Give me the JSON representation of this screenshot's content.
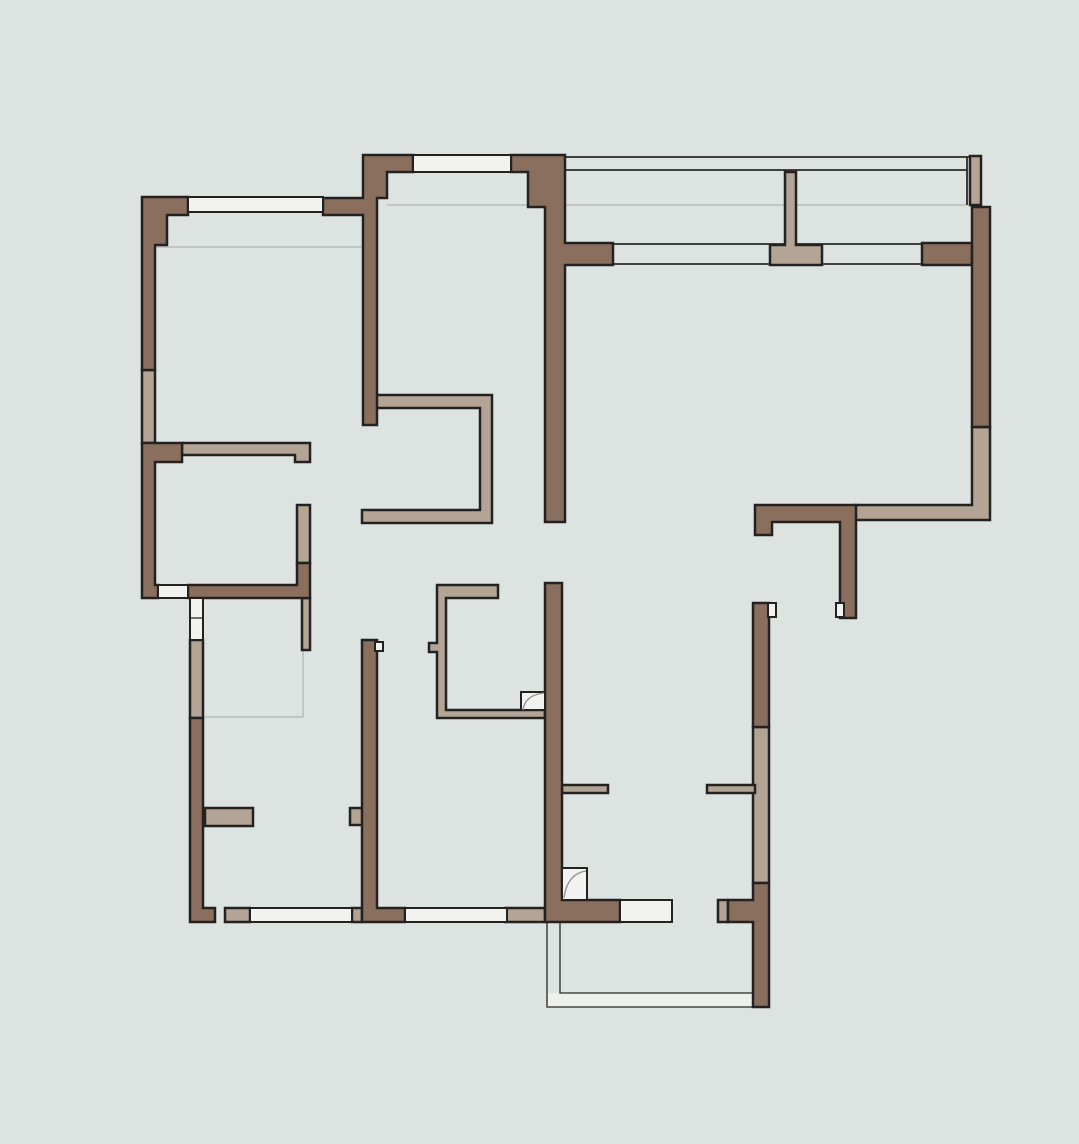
{
  "canvas": {
    "width": 1079,
    "height": 1144,
    "background": "#dde3e1"
  },
  "palette": {
    "background": "#dde3e1",
    "wall_brown": "#8a6e5e",
    "wall_beige": "#b3a496",
    "outline": "#242220",
    "window_white": "#f2f2f0",
    "faint_line": "#b5bcba",
    "swing_line": "#8a8f8d",
    "band_fill": "#eef0ee"
  },
  "layers": {
    "faint": {
      "stroke": "#b5bcba",
      "width": 1.5,
      "fill": "none"
    },
    "band-fill": {
      "stroke": "none",
      "width": 0,
      "fill": "#eef0ee"
    },
    "dark-line": {
      "stroke": "#2a2824",
      "width": 1.8,
      "fill": "none"
    },
    "thin-line": {
      "stroke": "#2a2824",
      "width": 1.3,
      "fill": "none"
    },
    "beige": {
      "stroke": "#242220",
      "width": 2.5,
      "fill": "#b3a496"
    },
    "brown": {
      "stroke": "#242220",
      "width": 2.5,
      "fill": "#8a6e5e"
    },
    "white": {
      "stroke": "#242220",
      "width": 2,
      "fill": "#f2f2f0"
    },
    "swing": {
      "stroke": "#8a8f8d",
      "width": 1.3,
      "fill": "none"
    }
  },
  "floorplan": {
    "elements": [
      {
        "name": "bedroom1-curtain-line",
        "layer": "faint",
        "type": "line",
        "c": [
          155,
          247,
          363,
          247
        ]
      },
      {
        "name": "bedroom2-curtain-line",
        "layer": "faint",
        "type": "line",
        "c": [
          387,
          205,
          545,
          205
        ]
      },
      {
        "name": "balcony-top-inner-line",
        "layer": "faint",
        "type": "line",
        "c": [
          565,
          205,
          967,
          205
        ]
      },
      {
        "name": "closet-outline-vertical",
        "layer": "faint",
        "type": "line",
        "c": [
          303,
          565,
          303,
          717
        ]
      },
      {
        "name": "closet-outline-horizontal",
        "layer": "faint",
        "type": "line",
        "c": [
          205,
          717,
          303,
          717
        ]
      },
      {
        "name": "balcony-bottom-band",
        "layer": "band-fill",
        "type": "rect",
        "c": [
          548,
          993,
          222,
          14
        ]
      },
      {
        "name": "balcony-bottom-outer",
        "layer": "thin-line",
        "type": "polyline",
        "pts": "547,922 547,1007 770,1007"
      },
      {
        "name": "balcony-bottom-inner",
        "layer": "thin-line",
        "type": "polyline",
        "pts": "560,922 560,993 753,993"
      },
      {
        "name": "balcony-glass-outer-line",
        "layer": "dark-line",
        "type": "line",
        "c": [
          565,
          157,
          981,
          157
        ]
      },
      {
        "name": "balcony-glass-inner-line",
        "layer": "dark-line",
        "type": "line",
        "c": [
          565,
          170,
          967,
          170
        ]
      },
      {
        "name": "balcony-glass-right-line",
        "layer": "dark-line",
        "type": "line",
        "c": [
          967,
          157,
          967,
          205
        ]
      },
      {
        "name": "living-window-top-line",
        "layer": "dark-line",
        "type": "line",
        "c": [
          613,
          244,
          922,
          244
        ]
      },
      {
        "name": "living-window-bottom-line",
        "layer": "dark-line",
        "type": "line",
        "c": [
          613,
          264,
          922,
          264
        ]
      },
      {
        "name": "left-wall-window-panel",
        "layer": "beige",
        "type": "rect",
        "c": [
          142,
          370,
          13,
          73
        ]
      },
      {
        "name": "hall-wall-beige",
        "layer": "beige",
        "type": "poly",
        "pts": "182,443 310,443 310,462 295,462 295,455 182,455"
      },
      {
        "name": "closet-wall-upper",
        "layer": "beige",
        "type": "rect",
        "c": [
          297,
          505,
          13,
          58
        ]
      },
      {
        "name": "closet-wall-lower",
        "layer": "beige",
        "type": "rect",
        "c": [
          302,
          598,
          8,
          52
        ]
      },
      {
        "name": "entry-wall-panel",
        "layer": "beige",
        "type": "rect",
        "c": [
          190,
          640,
          13,
          78
        ]
      },
      {
        "name": "wardrobe-unit",
        "layer": "beige",
        "type": "poly",
        "pts": "372,395 492,395 492,523 362,523 362,510 480,510 480,408 372,408"
      },
      {
        "name": "kitchen-wall-unit",
        "layer": "beige",
        "type": "poly",
        "pts": "437,585 498,585 498,598 446,598 446,710 545,710 545,718 437,718 437,652 429,652 429,643 437,643"
      },
      {
        "name": "balcony-column",
        "layer": "beige",
        "type": "poly",
        "pts": "785,172 796,172 796,245 822,245 822,265 770,265 770,245 785,245"
      },
      {
        "name": "right-wall-window-panel",
        "layer": "beige",
        "type": "poly",
        "pts": "972,427 990,427 990,520 855,520 855,505 972,505"
      },
      {
        "name": "right-lower-wall-panel",
        "layer": "beige",
        "type": "rect",
        "c": [
          753,
          727,
          16,
          156
        ]
      },
      {
        "name": "door-jamb-stub-left",
        "layer": "beige",
        "type": "rect",
        "c": [
          562,
          785,
          46,
          8
        ]
      },
      {
        "name": "door-jamb-stub-right",
        "layer": "beige",
        "type": "rect",
        "c": [
          707,
          785,
          48,
          8
        ]
      },
      {
        "name": "bath-fixture-bar",
        "layer": "beige",
        "type": "rect",
        "c": [
          205,
          808,
          48,
          18
        ]
      },
      {
        "name": "wall-block-small",
        "layer": "beige",
        "type": "rect",
        "c": [
          350,
          808,
          15,
          17
        ]
      },
      {
        "name": "sill-block-left",
        "layer": "beige",
        "type": "rect",
        "c": [
          225,
          908,
          25,
          14
        ]
      },
      {
        "name": "sill-block-mid",
        "layer": "beige",
        "type": "rect",
        "c": [
          352,
          908,
          10,
          14
        ]
      },
      {
        "name": "sill-block-right",
        "layer": "beige",
        "type": "rect",
        "c": [
          505,
          908,
          40,
          14
        ]
      },
      {
        "name": "sill-block-door",
        "layer": "beige",
        "type": "rect",
        "c": [
          718,
          900,
          10,
          22
        ]
      },
      {
        "name": "glazing-end-post",
        "layer": "beige",
        "type": "rect",
        "c": [
          970,
          156,
          11,
          49
        ]
      },
      {
        "name": "wall-top-left-corner",
        "layer": "brown",
        "type": "poly",
        "pts": "142,197 188,197 188,215 167,215 167,245 155,245 155,370 142,370"
      },
      {
        "name": "wall-bedroom-divider",
        "layer": "brown",
        "type": "poly",
        "pts": "323,198 363,198 363,155 413,155 413,172 387,172 387,198 377,198 377,425 363,425 363,215 323,215"
      },
      {
        "name": "wall-living-left",
        "layer": "brown",
        "type": "poly",
        "pts": "511,155 565,155 565,243 613,243 613,265 565,265 565,522 545,522 545,207 528,207 528,172 511,172"
      },
      {
        "name": "wall-window-stub-right",
        "layer": "brown",
        "type": "rect",
        "c": [
          922,
          243,
          50,
          22
        ]
      },
      {
        "name": "wall-right-upper",
        "layer": "brown",
        "type": "rect",
        "c": [
          972,
          207,
          18,
          220
        ]
      },
      {
        "name": "wall-dining-corner",
        "layer": "brown",
        "type": "poly",
        "pts": "755,505 856,505 856,618 840,618 840,522 772,522 772,535 755,535"
      },
      {
        "name": "wall-center-vertical",
        "layer": "brown",
        "type": "poly",
        "pts": "545,583 562,583 562,900 620,900 620,922 545,922"
      },
      {
        "name": "wall-left-lower",
        "layer": "brown",
        "type": "poly",
        "pts": "142,443 182,443 182,462 155,462 155,585 158,585 158,598 142,598"
      },
      {
        "name": "wall-hall-horizontal",
        "layer": "brown",
        "type": "poly",
        "pts": "188,585 297,585 297,563 310,563 310,598 188,598"
      },
      {
        "name": "wall-entry-lower",
        "layer": "brown",
        "type": "poly",
        "pts": "190,718 203,718 203,908 215,908 215,922 190,922"
      },
      {
        "name": "wall-bath-divider",
        "layer": "brown",
        "type": "poly",
        "pts": "362,640 377,640 377,908 405,908 405,922 362,922"
      },
      {
        "name": "wall-bottom-right",
        "layer": "brown",
        "type": "poly",
        "pts": "753,883 769,883 769,1007 753,1007 753,922 728,922 728,900 753,900"
      },
      {
        "name": "wall-right-mid",
        "layer": "brown",
        "type": "rect",
        "c": [
          753,
          603,
          16,
          124
        ]
      },
      {
        "name": "window-bedroom1",
        "layer": "white",
        "type": "rect",
        "c": [
          188,
          197,
          135,
          15
        ]
      },
      {
        "name": "window-bedroom2",
        "layer": "white",
        "type": "rect",
        "c": [
          413,
          155,
          98,
          17
        ]
      },
      {
        "name": "door-opening-hall",
        "layer": "white",
        "type": "rect",
        "c": [
          158,
          585,
          30,
          13
        ]
      },
      {
        "name": "door-jamb-entry",
        "layer": "white",
        "type": "rect",
        "c": [
          190,
          598,
          13,
          42
        ]
      },
      {
        "name": "door-jamb-entry-line",
        "layer": "thin-line",
        "type": "line",
        "c": [
          190,
          618,
          203,
          618
        ]
      },
      {
        "name": "window-bath",
        "layer": "white",
        "type": "rect",
        "c": [
          250,
          908,
          102,
          14
        ]
      },
      {
        "name": "window-bedroom3",
        "layer": "white",
        "type": "rect",
        "c": [
          405,
          908,
          102,
          14
        ]
      },
      {
        "name": "door-opening-balcony",
        "layer": "white",
        "type": "rect",
        "c": [
          620,
          900,
          52,
          22
        ]
      },
      {
        "name": "wall-notch-1",
        "layer": "white",
        "type": "rect",
        "c": [
          375,
          642,
          8,
          9
        ]
      },
      {
        "name": "wall-notch-2",
        "layer": "white",
        "type": "rect",
        "c": [
          768,
          603,
          8,
          14
        ]
      },
      {
        "name": "wall-notch-3",
        "layer": "white",
        "type": "rect",
        "c": [
          836,
          603,
          8,
          14
        ]
      },
      {
        "name": "door-leaf-kitchen",
        "layer": "white",
        "type": "rect",
        "c": [
          521,
          692,
          24,
          18
        ]
      },
      {
        "name": "door-leaf-balcony",
        "layer": "white",
        "type": "rect",
        "c": [
          562,
          868,
          25,
          32
        ]
      },
      {
        "name": "door-swing-kitchen",
        "layer": "swing",
        "type": "path",
        "d": "M 523,710 Q 525,695 544,693"
      },
      {
        "name": "door-swing-balcony",
        "layer": "swing",
        "type": "path",
        "d": "M 564,898 Q 567,874 586,871"
      }
    ]
  }
}
